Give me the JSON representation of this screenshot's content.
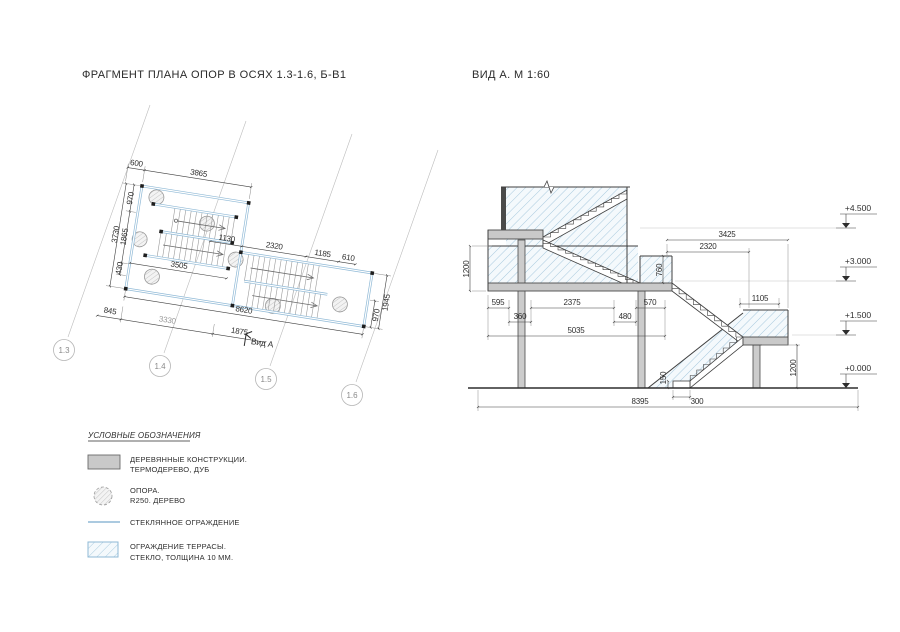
{
  "titles": {
    "plan": "ФРАГМЕНТ ПЛАНА ОПОР В ОСЯХ 1.3-1.6, Б-В1",
    "view": "ВИД А. М 1:60"
  },
  "plan": {
    "view_arrow_label": "Вид А",
    "axes": [
      "1.3",
      "1.4",
      "1.5",
      "1.6"
    ],
    "dims": {
      "d600": "600",
      "d3865": "3865",
      "d3730": "3730",
      "d1865": "1865",
      "d970_left": "970",
      "d430": "430",
      "d845": "845",
      "d3330": "3330",
      "d1875": "1875",
      "d3505": "3505",
      "d8620": "8620",
      "d1130": "1130",
      "d2320": "2320",
      "d1185": "1185",
      "d610": "610",
      "d970_right": "970",
      "d1945": "1945"
    }
  },
  "elevation": {
    "levels": [
      {
        "label": "+4.500"
      },
      {
        "label": "+3.000"
      },
      {
        "label": "+1.500"
      },
      {
        "label": "+0.000"
      }
    ],
    "dims": {
      "d1200_left": "1200",
      "d760": "760",
      "d3425": "3425",
      "d2320": "2320",
      "d1105": "1105",
      "d595": "595",
      "d360": "360",
      "d2375": "2375",
      "d480": "480",
      "d570": "570",
      "d5035": "5035",
      "d150": "150",
      "d300": "300",
      "d1200_right": "1200",
      "d8395": "8395"
    }
  },
  "legend": {
    "title": "УСЛОВНЫЕ ОБОЗНАЧЕНИЯ",
    "items": [
      {
        "label1": "ДЕРЕВЯННЫЕ КОНСТРУКЦИИ.",
        "label2": "ТЕРМОДЕРЕВО, ДУБ",
        "symbol": "wood-fill"
      },
      {
        "label1": "ОПОРА.",
        "label2": "R250. ДЕРЕВО",
        "symbol": "support-circle"
      },
      {
        "label1": "СТЕКЛЯННОЕ ОГРАЖДЕНИЕ",
        "label2": "",
        "symbol": "glass-line"
      },
      {
        "label1": "ОГРАЖДЕНИЕ ТЕРРАСЫ.",
        "label2": "СТЕКЛО, ТОЛЩИНА 10 ММ.",
        "symbol": "terrace-glass-hatch"
      }
    ]
  },
  "colors": {
    "line": "#3f3f3f",
    "railing_blue": "#8fb9d6",
    "glass_hatch": "#a9cade",
    "wood_gray": "#c9c9c9",
    "aux_gray": "#bcbcbc"
  }
}
